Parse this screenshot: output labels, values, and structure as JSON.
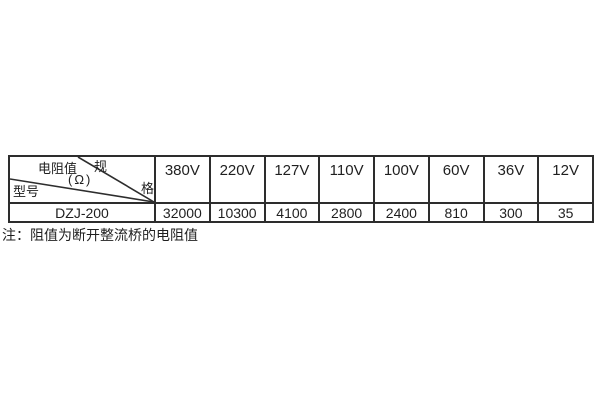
{
  "table": {
    "corner": {
      "spec_top": "规",
      "spec_bottom": "格",
      "resistance_label": "电阻值",
      "resistance_unit": "(Ω)",
      "model_label": "型号"
    },
    "voltage_columns": [
      "380V",
      "220V",
      "127V",
      "110V",
      "100V",
      "60V",
      "36V",
      "12V"
    ],
    "rows": [
      {
        "model": "DZJ-200",
        "values": [
          "32000",
          "10300",
          "4100",
          "2800",
          "2400",
          "810",
          "300",
          "35"
        ]
      }
    ]
  },
  "note": "注：阻值为断开整流桥的电阻值",
  "colors": {
    "border": "#2d2d2d",
    "text": "#1f1f1f",
    "background": "#ffffff"
  }
}
